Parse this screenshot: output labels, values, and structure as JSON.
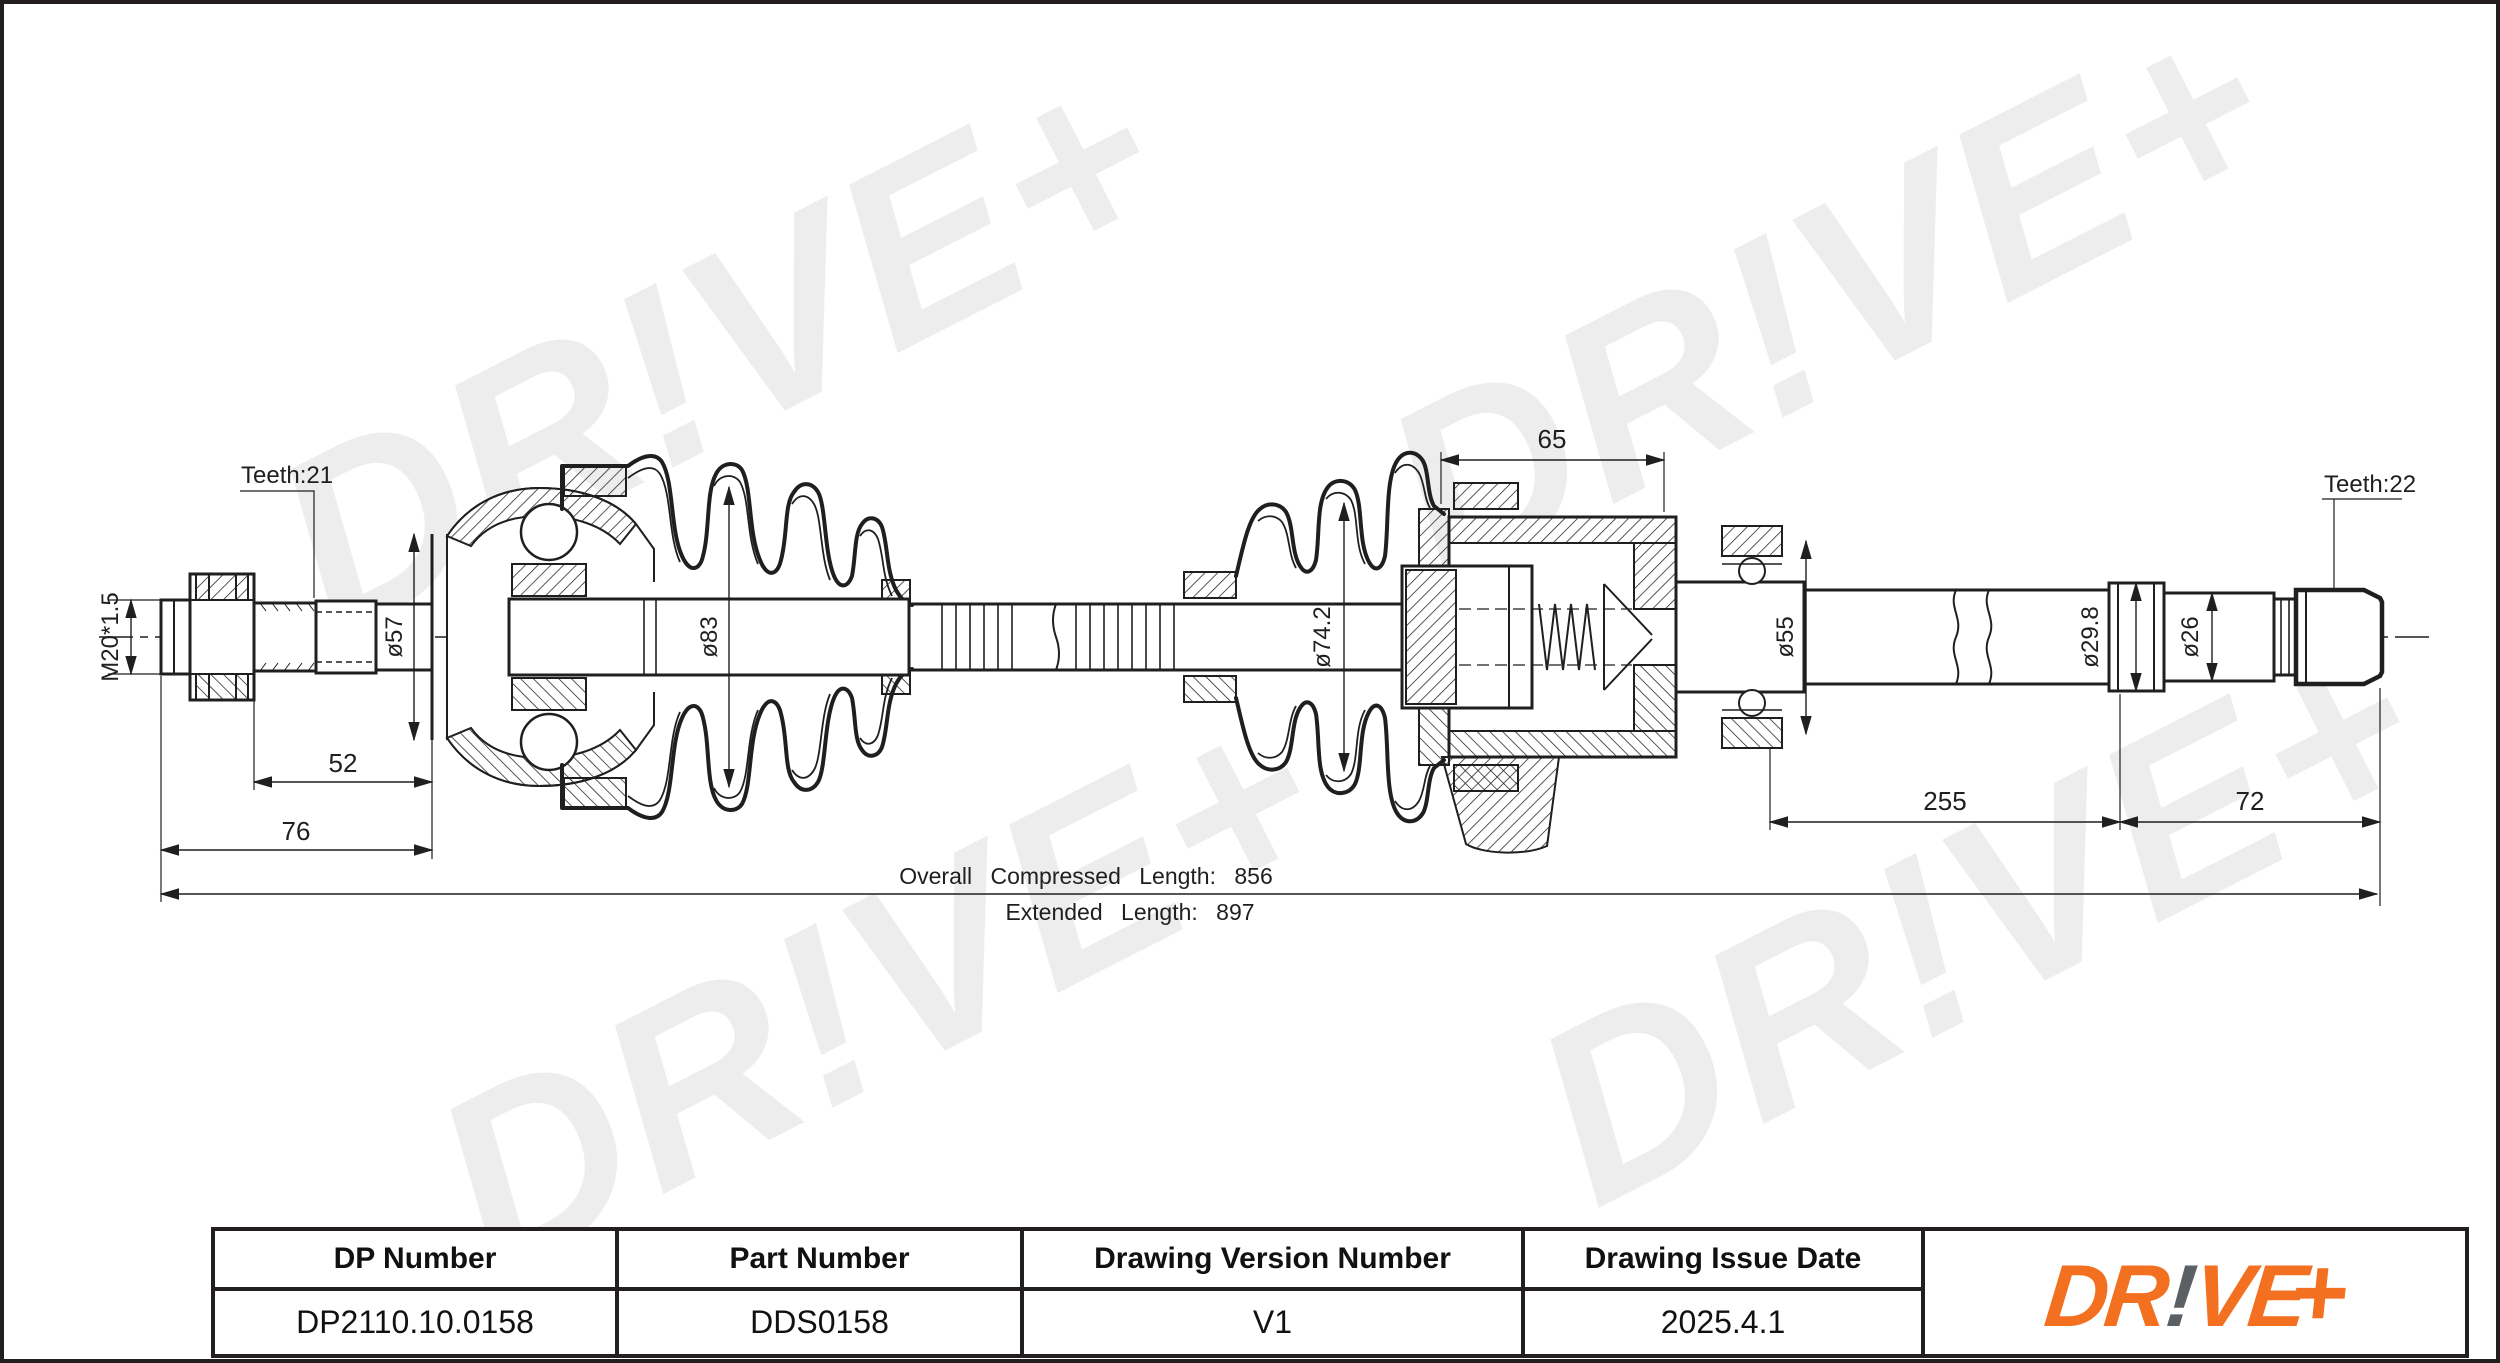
{
  "page": {
    "border_color": "#241f1f",
    "background": "#ffffff"
  },
  "watermark": {
    "text": "DR!VE+",
    "color": "#ededed"
  },
  "drawing": {
    "labels": {
      "teeth_left": "Teeth:21",
      "teeth_right": "Teeth:22",
      "thread": "M20*1.5",
      "d57": "ø57",
      "d83": "ø83",
      "d742": "ø74.2",
      "d55": "ø55",
      "d298": "ø29.8",
      "d26": "ø26",
      "len52": "52",
      "len76": "76",
      "len65": "65",
      "len255": "255",
      "len72": "72",
      "compressed": "Overall Compressed Length: 856",
      "extended": "Extended Length: 897"
    }
  },
  "title_block": {
    "columns": [
      {
        "header": "DP Number",
        "value": "DP2110.10.0158"
      },
      {
        "header": "Part Number",
        "value": "DDS0158"
      },
      {
        "header": "Drawing Version Number",
        "value": "V1"
      },
      {
        "header": "Drawing Issue Date",
        "value": "2025.4.1"
      }
    ],
    "logo": {
      "part1": "DR",
      "bang": "!",
      "part2": "VE",
      "plus": "+",
      "orange": "#F37021",
      "gray": "#5B6065"
    }
  }
}
